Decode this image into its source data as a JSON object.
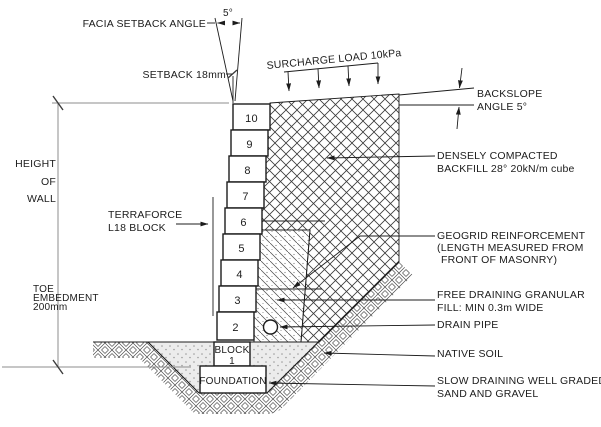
{
  "annotations": {
    "facia_setback_angle": "FACIA SETBACK ANGLE",
    "facia_angle_value": "5°",
    "setback": "SETBACK 18mm",
    "surcharge": "SURCHARGE LOAD  10kPa",
    "backslope_1": "BACKSLOPE",
    "backslope_2": "ANGLE 5°",
    "height_1": "HEIGHT",
    "height_2": "OF",
    "height_3": "WALL",
    "terraforce_1": "TERRAFORCE",
    "terraforce_2": "L18 BLOCK",
    "toe_1": "TOE",
    "toe_2": "EMBEDMENT",
    "toe_3": "200mm",
    "backfill_1": "DENSELY COMPACTED",
    "backfill_2": "BACKFILL 28°  20kN/m cube",
    "geogrid_1": "GEOGRID REINFORCEMENT",
    "geogrid_2": "(LENGTH MEASURED FROM",
    "geogrid_3": "FRONT OF MASONRY)",
    "granular_1": "FREE DRAINING GRANULAR",
    "granular_2": "FILL: MIN 0.3m WIDE",
    "drain_pipe": "DRAIN PIPE",
    "native_soil": "NATIVE SOIL",
    "slow_1": "SLOW DRAINING WELL GRADED",
    "slow_2": "SAND AND GRAVEL"
  },
  "wall": {
    "courses": [
      "10",
      "9",
      "8",
      "7",
      "6",
      "5",
      "4",
      "3",
      "2"
    ],
    "block1_1": "BLOCK",
    "block1_2": "1",
    "foundation": "FOUNDATION"
  },
  "colors": {
    "line": "#1c1c1c",
    "dimension_line": "#8e8e8e",
    "background": "#ffffff"
  }
}
